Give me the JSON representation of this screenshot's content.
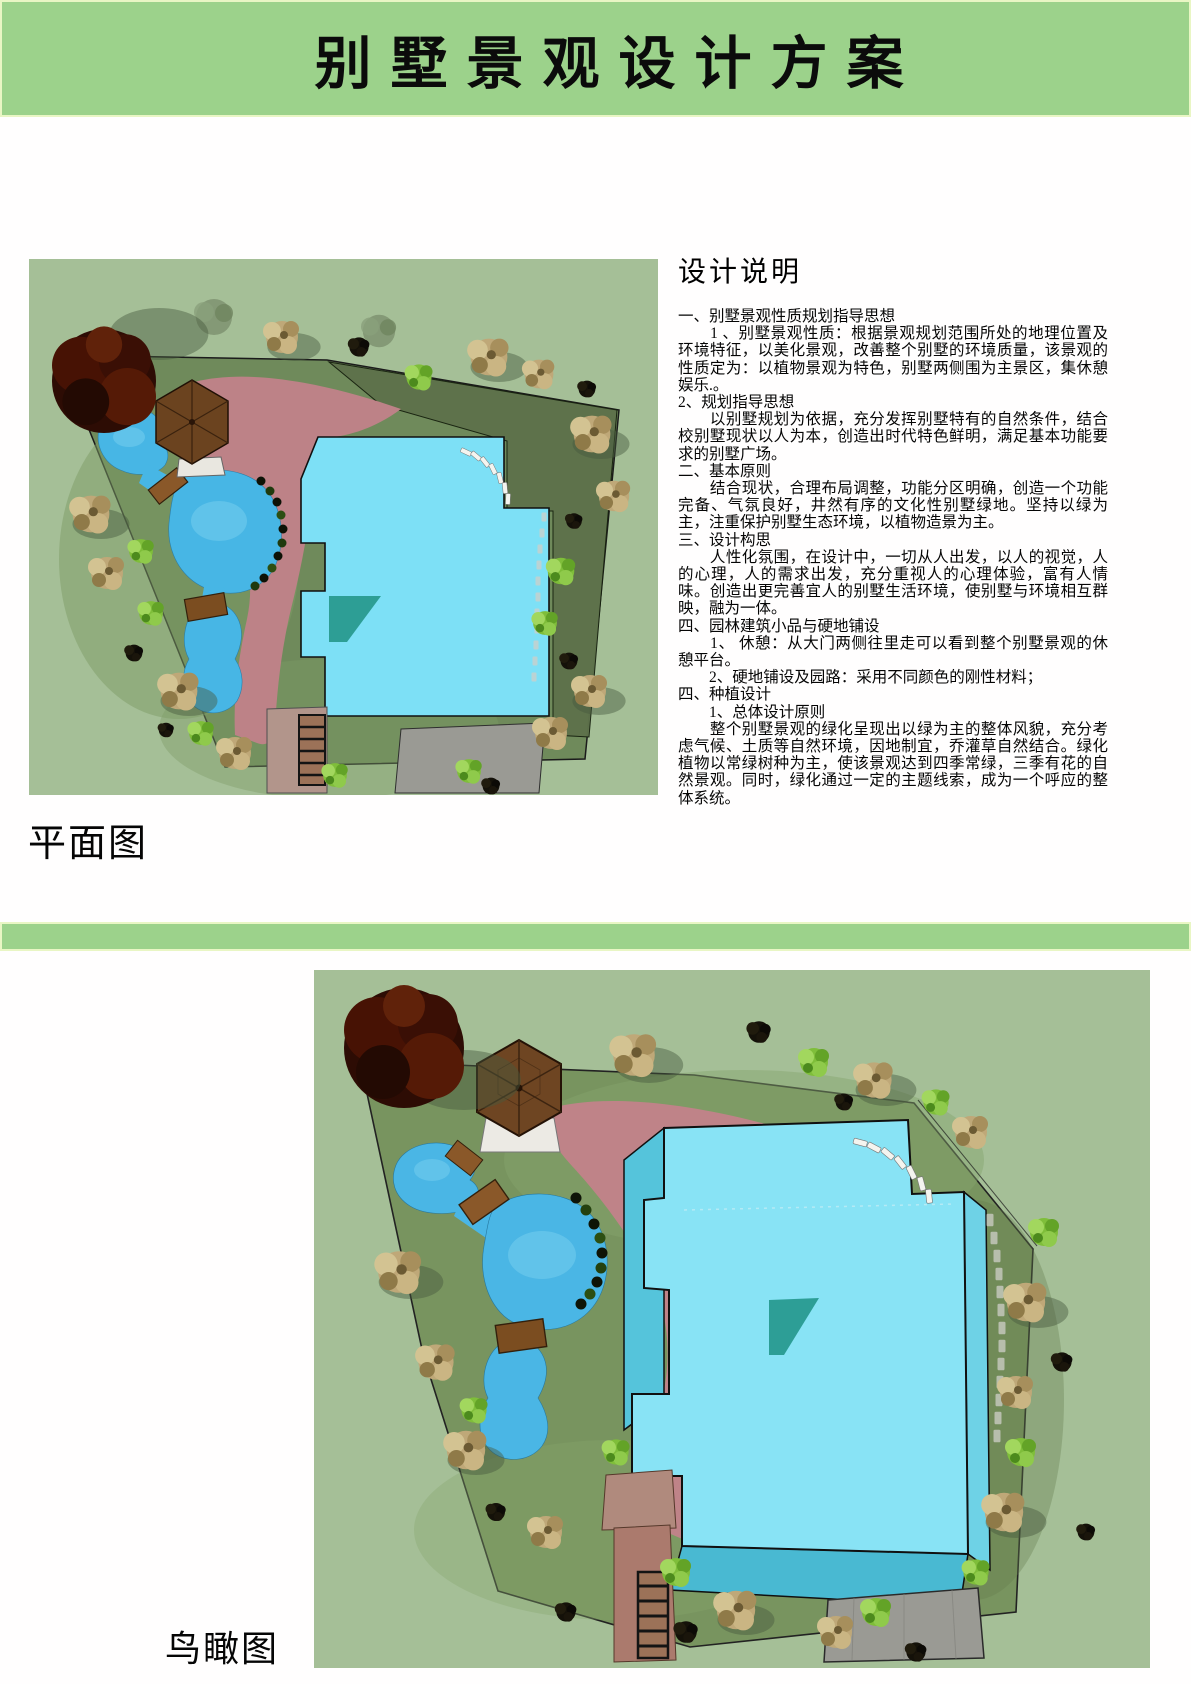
{
  "header": {
    "title": "别墅景观设计方案"
  },
  "description": {
    "heading": "设计说明",
    "paragraphs": [
      "一、别墅景观性质规划指导思想",
      "　　1 、别墅景观性质：根据景观规划范围所处的地理位置及环境特征，以美化景观，改善整个别墅的环境质量，该景观的性质定为：以植物景观为特色，别墅两侧围为主景区，集休憩娱乐.。",
      "2、规划指导思想",
      "　　以别墅规划为依据，充分发挥别墅特有的自然条件，结合校别墅现状以人为本，创造出时代特色鲜明，满足基本功能要求的别墅广场。",
      "二、基本原则",
      "　　结合现状，合理布局调整，功能分区明确，创造一个功能完备、气氛良好，井然有序的文化性别墅绿地。坚持以绿为主，注重保护别墅生态环境，以植物造景为主。",
      "三、设计构思",
      "　　人性化氛围，在设计中，一切从人出发，以人的视觉，人的心理，人的需求出发，充分重视人的心理体验，富有人情味。创造出更完善宜人的别墅生活环境，使别墅与环境相互群映，融为一体。",
      "四、园林建筑小品与硬地铺设",
      "　　1、 休憩：从大门两侧往里走可以看到整个别墅景观的休憩平台。",
      "　　2、硬地铺设及园路：采用不同颜色的刚性材料；",
      "四、种植设计",
      "　　1、总体设计原则",
      "　　整个别墅景观的绿化呈现出以绿为主的整体风貌，充分考虑气候、土质等自然环境，因地制宜，乔灌草自然结合。绿化植物以常绿树种为主，使该景观达到四季常绿，三季有花的自然景观。同时，绿化通过一定的主题线索，成为一个呼应的整体系统。"
    ]
  },
  "sections": {
    "plan": {
      "label": "平面图"
    },
    "bird": {
      "label": "鸟瞰图"
    }
  },
  "colors": {
    "banner_green": "#9cd28b",
    "banner_border": "#e9f6c4",
    "canvas_green": "#a5bf97",
    "lawn_green": "#6f8a5b",
    "dark_olive": "#5e724b",
    "water_blue": "#47b6e5",
    "building_cyan": "#7de0f6",
    "plaza_rose": "#bd8287",
    "roof_brown": "#6e4522",
    "paving_gray": "#9a9a94"
  }
}
